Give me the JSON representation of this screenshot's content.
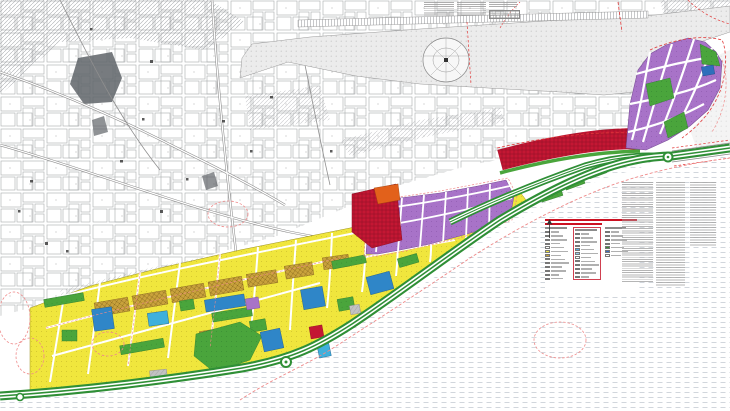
{
  "document": {
    "kind": "zoning-plan-map",
    "readable_text": [],
    "note_blocks": {
      "top_note_columns": 3,
      "top_has_table": true,
      "right_fine_print_columns": 3
    }
  },
  "colors": {
    "residential": "#f0e63d",
    "residential_dot": "#c9b92a",
    "mixed": "#c9a23c",
    "mixed_hatch": "#8a6b1f",
    "commercial": "#c41733",
    "commercial_hatch": "#8f0e24",
    "orange": "#e2611b",
    "purple": "#a873c8",
    "purple_dot": "#8d59ae",
    "purple_edge": "#7a4f96",
    "park": "#2f8f36",
    "park2": "#4aa53c",
    "park_dot": "#2d7a2e",
    "blue": "#2f86c8",
    "cyan": "#3fb0dc",
    "blue_dark": "#2f6fbb",
    "gray_parcel": "#c2c2c2",
    "cad_line": "#a8abad",
    "road_line": "#8a8a8a",
    "dotted_fill": "#ececec",
    "dotted_dot": "#bdbdbd",
    "sea_line": "#c6ccd4",
    "hatch_line": "#8f9296",
    "boundary_red": "#e23a3a",
    "cloud_pink": "#ef8a8a",
    "legend_title": "#cc1122",
    "fine_print": "#a8a8a8",
    "blob_dark": "#5f6468"
  },
  "legend": {
    "title_color": "#cc1122",
    "title_lines": 2,
    "north_arrow": true,
    "columns": [
      {
        "name": "existing-uses",
        "boxed": false,
        "swatches": [
          "#ffffff",
          "#f5f5f5",
          "#e8e8e8",
          "#d8d8d8",
          "#ffffff",
          "#f0e63d",
          "#c9a23c",
          "#e2611b",
          "#cc2233",
          "#8c1a1a",
          "#7a4a2a",
          "#9a55b5",
          "#c9a0dd"
        ]
      },
      {
        "name": "proposed-uses",
        "boxed": true,
        "swatches": [
          "#e03040",
          "#e8707a",
          "#f0a0a8",
          "#2f86c8",
          "#58aadd",
          "#9cc8ea",
          "#ffffff",
          "#2e8b3a",
          "#56b44a",
          "#9ad06a",
          "#cde89a",
          "#e03040"
        ]
      },
      {
        "name": "symbols",
        "boxed": false,
        "swatches": [
          "#888888",
          "#bbbbbb",
          "#dddddd",
          "#333333",
          "#3a8c3a",
          "#3a6abd",
          "#ffffff"
        ]
      }
    ]
  }
}
